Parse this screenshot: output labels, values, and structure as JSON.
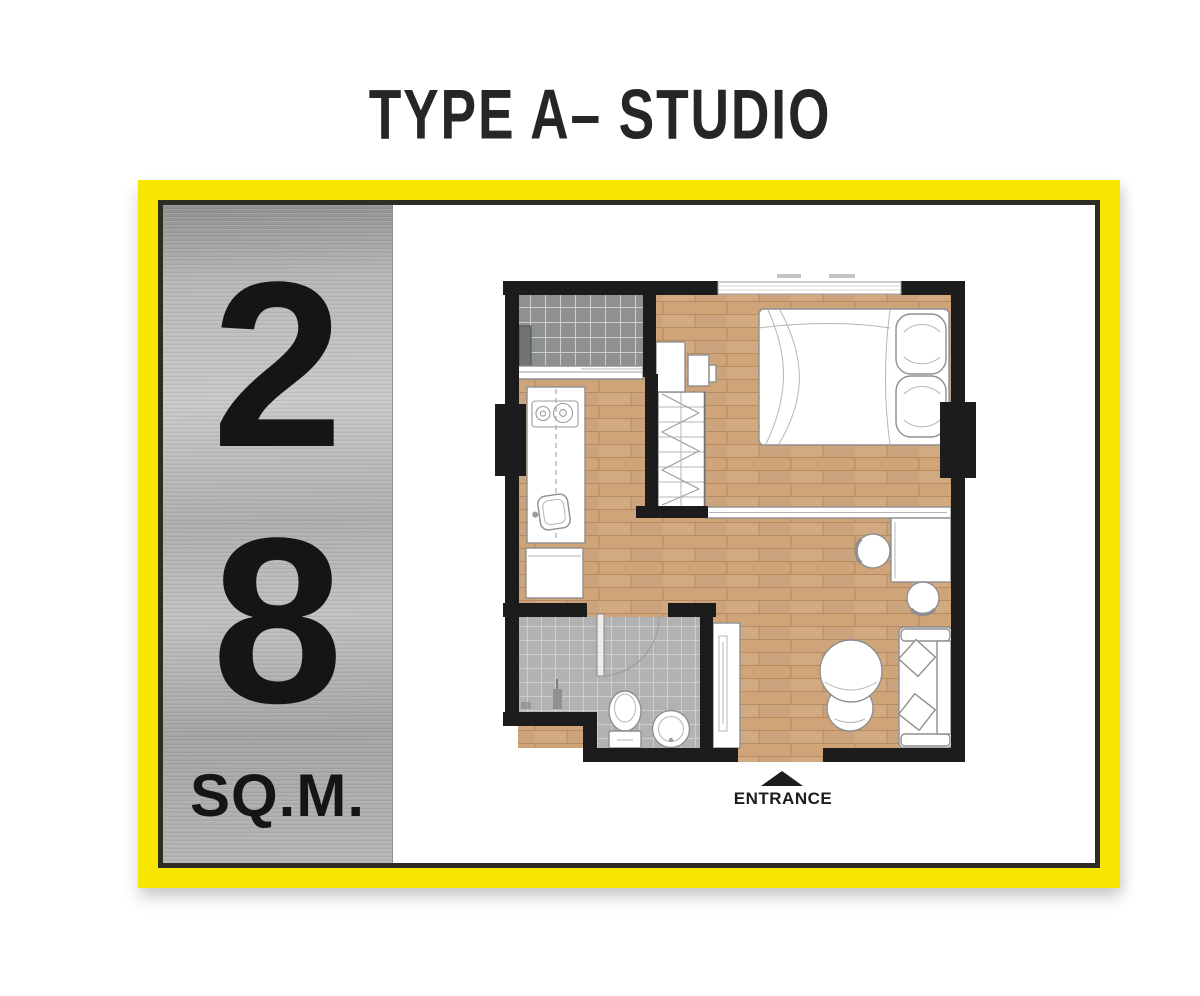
{
  "title": "TYPE A– STUDIO",
  "card": {
    "area": {
      "digits": [
        "2",
        "8"
      ],
      "unit": "SQ.M."
    }
  },
  "floor_plan": {
    "entrance_label": "ENTRANCE",
    "features": [
      "balcony",
      "sliding-door",
      "kitchen-counter",
      "stove",
      "kitchen-sink",
      "fridge",
      "wardrobe",
      "tv-console",
      "tv",
      "double-bed",
      "pillows",
      "window-top",
      "window-left",
      "window-right",
      "partition-shelf",
      "desk",
      "desk-chairs",
      "armchair",
      "ottoman",
      "sofa",
      "shoe-cabinet",
      "bathroom",
      "bathroom-door",
      "shower",
      "toilet",
      "wash-basin",
      "entrance-door"
    ]
  },
  "colors": {
    "frame_yellow": "#f7e600",
    "frame_border": "#2e2d24",
    "wall": "#1c1c1c",
    "wood": "#cfa478",
    "wood_line": "#b98a5e",
    "balcony_tile": "#8e9091",
    "bath_tile": "#b2b2b2",
    "furniture_stroke": "#8f8f8f",
    "text": "#262626"
  }
}
